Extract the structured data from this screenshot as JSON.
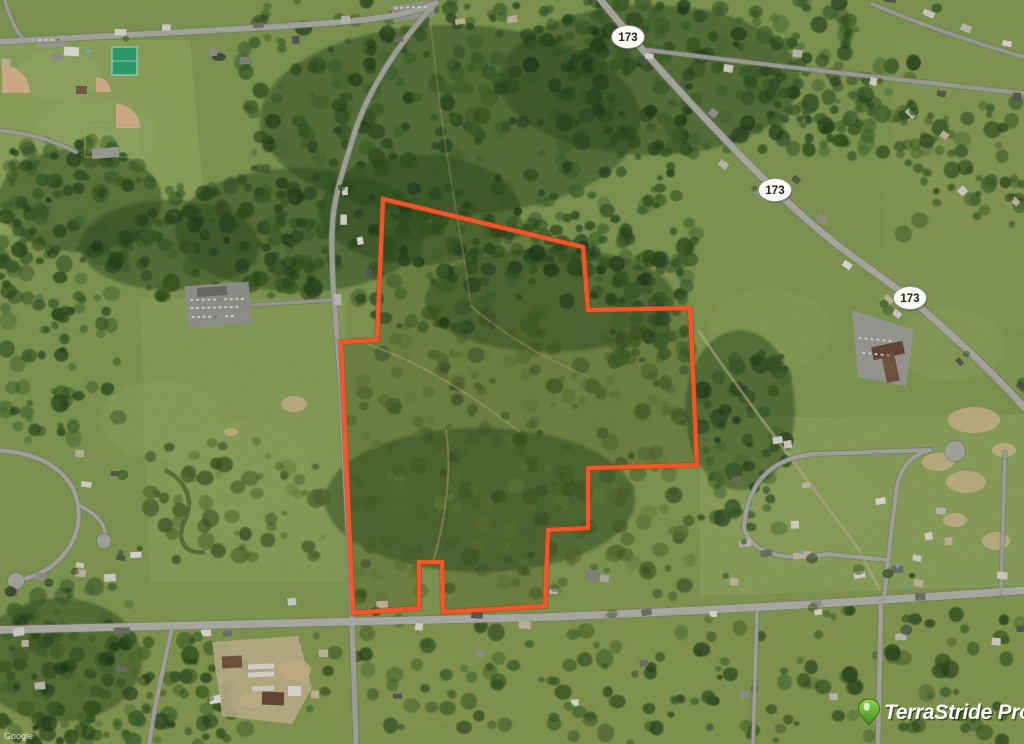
{
  "map": {
    "type": "aerial-satellite",
    "route_shields": [
      {
        "label": "173",
        "x": 628,
        "y": 37
      },
      {
        "label": "173",
        "x": 775,
        "y": 190
      },
      {
        "label": "173",
        "x": 910,
        "y": 298
      }
    ],
    "parcel_boundary": {
      "color": "#f2582c",
      "points": "383,199 583,247 588,310 690,308 697,465 588,468 588,528 548,530 545,606 443,612 442,562 419,562 419,608 353,613 341,342 377,340"
    },
    "attribution": "Google"
  },
  "branding": {
    "logo_text": "TerraStride Pro",
    "logo_text_color": "#ffffff",
    "pin_color": "#5cb531"
  }
}
